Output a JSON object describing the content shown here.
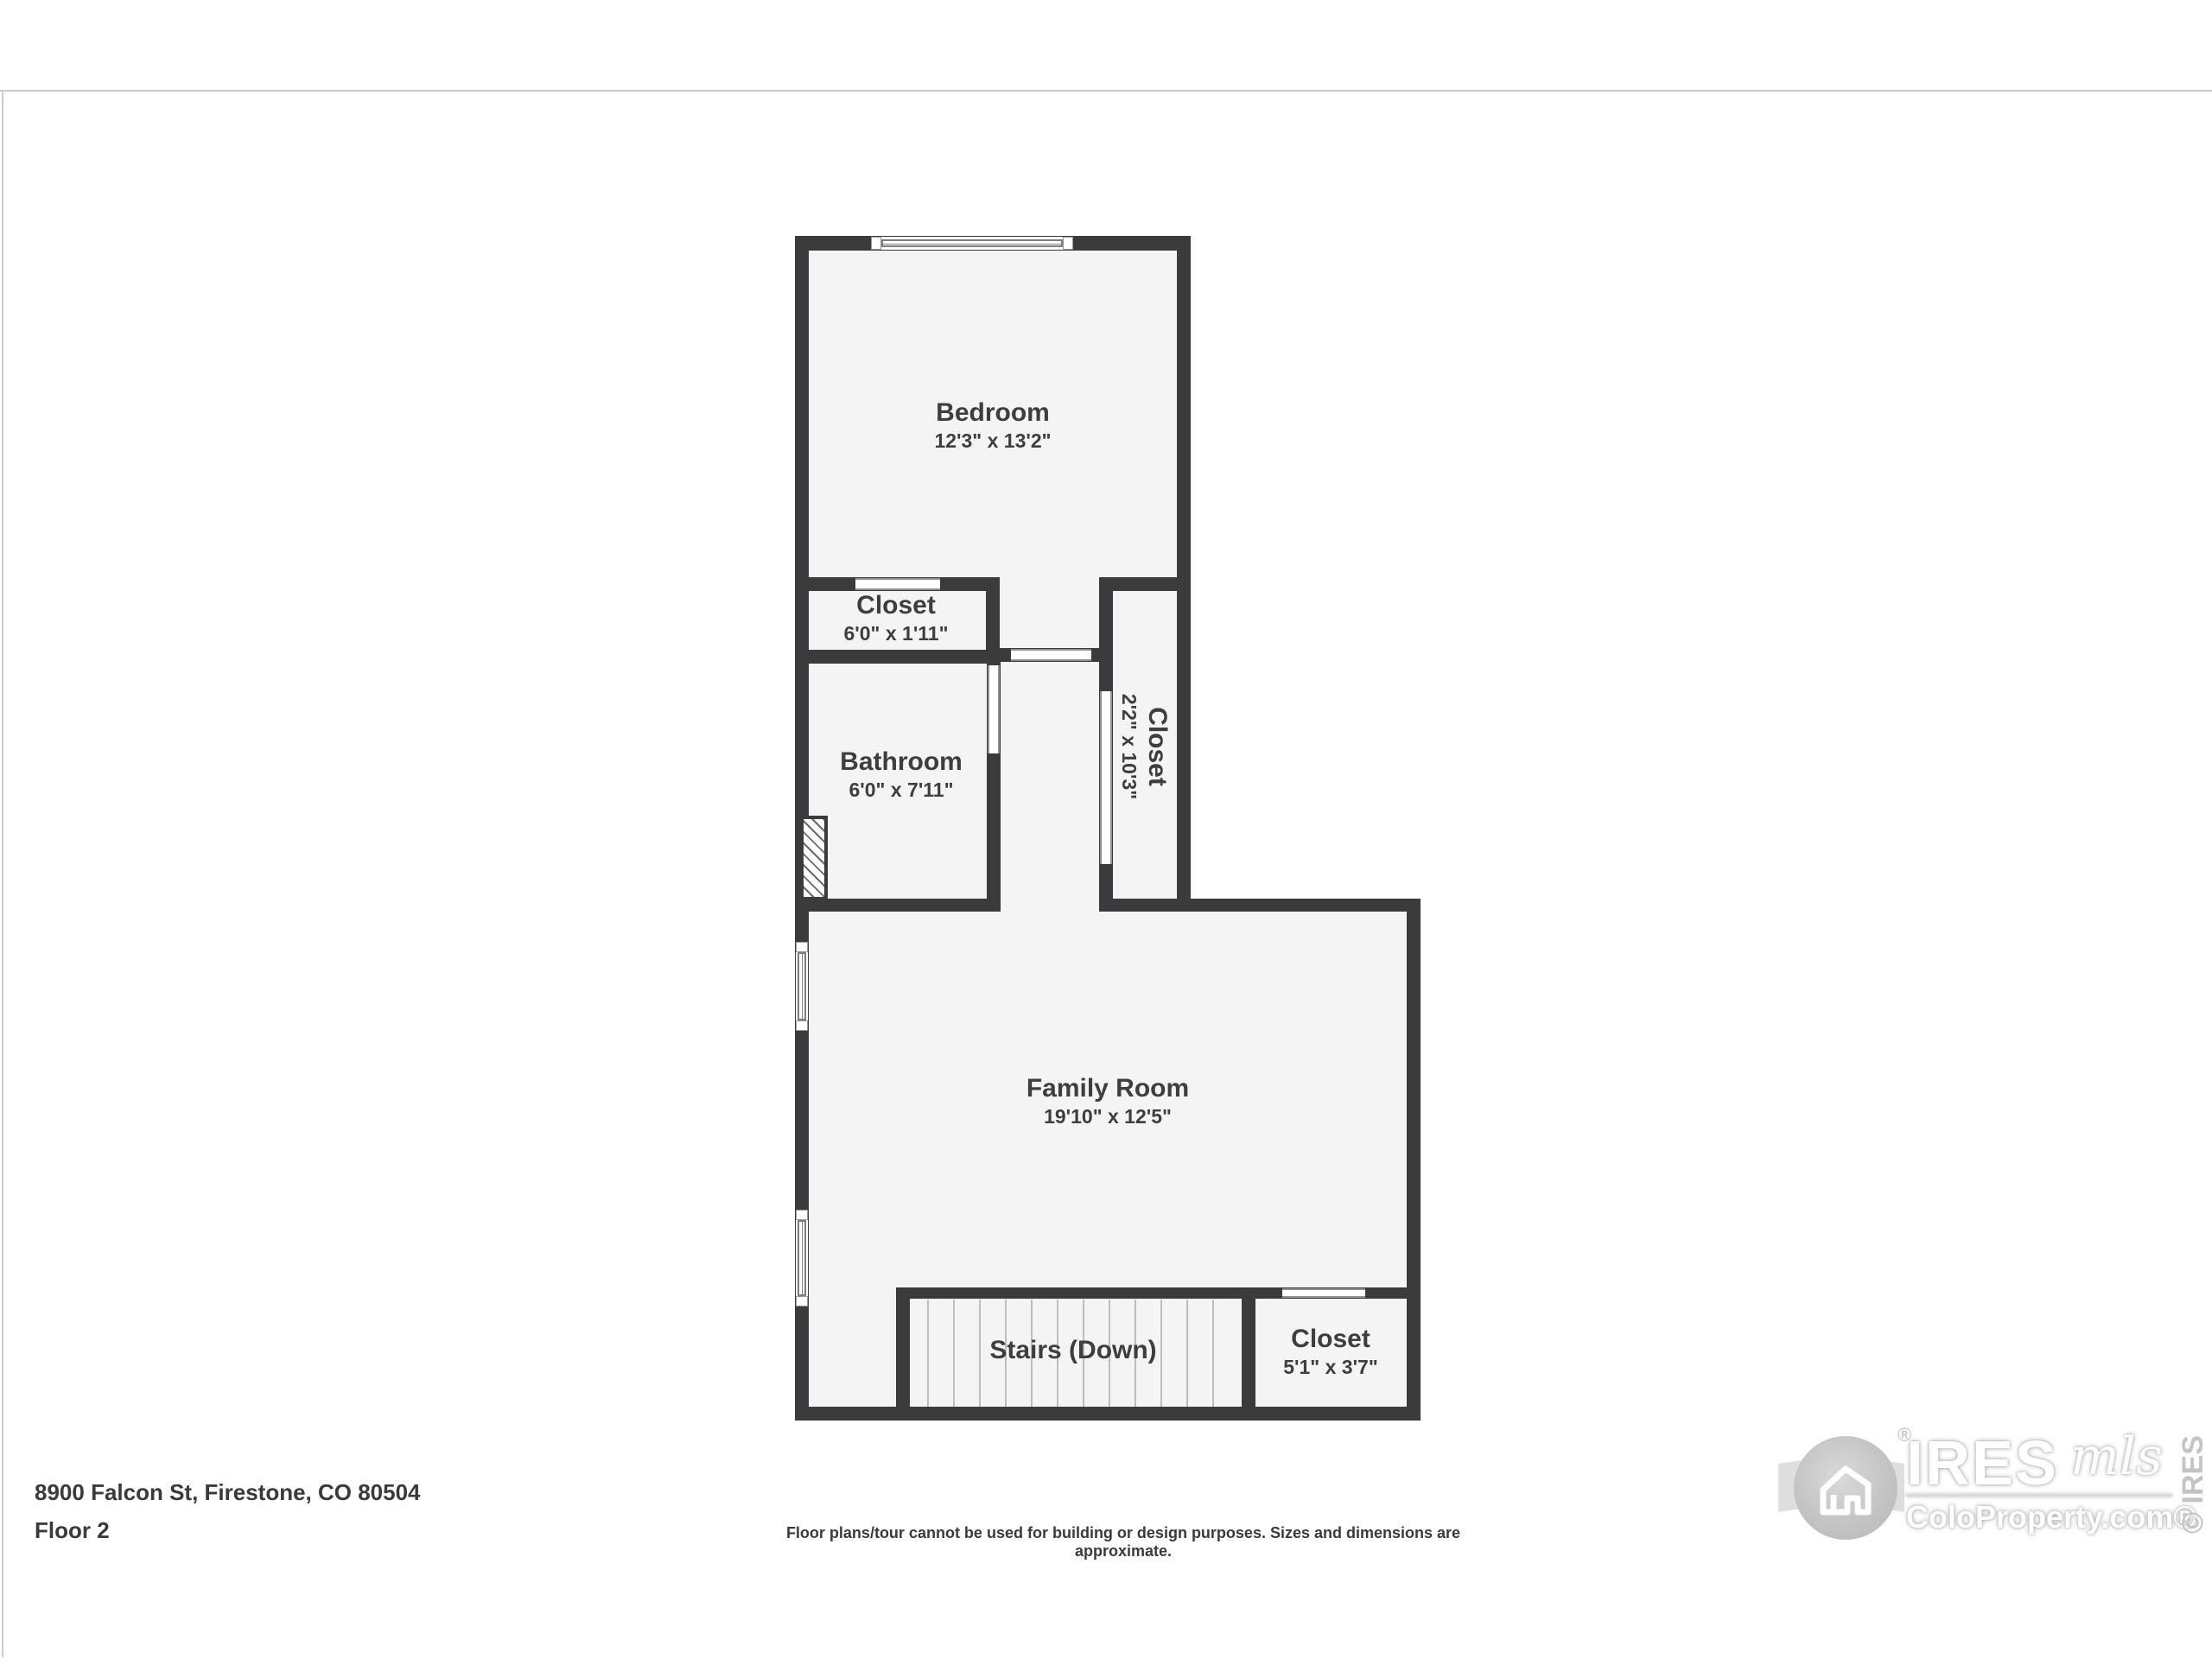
{
  "page": {
    "address": "8900 Falcon St, Firestone, CO 80504",
    "floor_label": "Floor 2",
    "disclaimer": "Floor plans/tour cannot be used for building or design purposes. Sizes and dimensions are approximate."
  },
  "rooms": {
    "bedroom": {
      "name": "Bedroom",
      "dims": "12'3\" x 13'2\""
    },
    "closet_top": {
      "name": "Closet",
      "dims": "6'0\" x 1'11\""
    },
    "bathroom": {
      "name": "Bathroom",
      "dims": "6'0\" x 7'11\""
    },
    "closet_hall": {
      "name": "Closet",
      "dims": "2'2\" x 10'3\""
    },
    "family_room": {
      "name": "Family Room",
      "dims": "19'10\" x 12'5\""
    },
    "stairs": {
      "name": "Stairs (Down)"
    },
    "closet_lower": {
      "name": "Closet",
      "dims": "5'1\" x 3'7\""
    }
  },
  "logo": {
    "brand": "IRES",
    "script": "mls",
    "site": "ColoProperty.com®",
    "reg": "®",
    "copyright": "© IRES"
  },
  "colors": {
    "wall": "#3b3b3d",
    "room_fill": "#f4f4f4",
    "label_text": "#3e3e40",
    "watermark": "#c4c4c4"
  }
}
